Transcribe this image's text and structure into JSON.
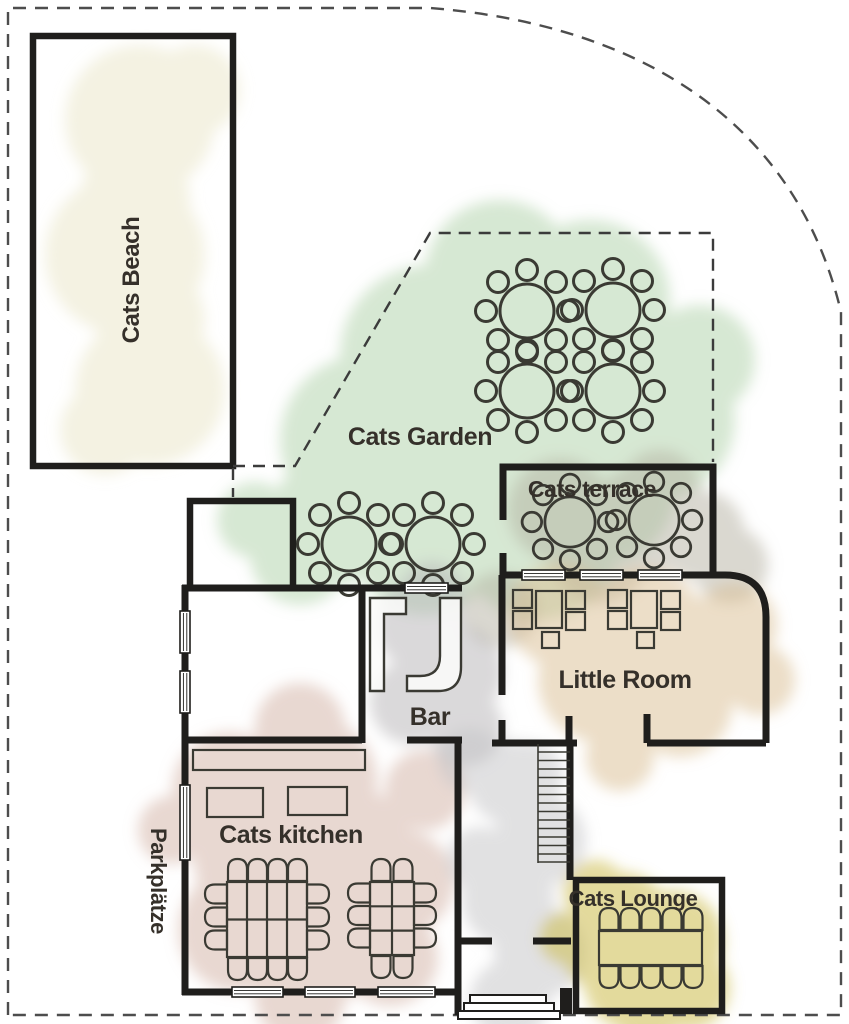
{
  "labels": {
    "beach": "Cats Beach",
    "garden": "Cats Garden",
    "terrace": "Cats terrace",
    "little_room": "Little Room",
    "bar": "Bar",
    "kitchen": "Cats kitchen",
    "lounge": "Cats Lounge",
    "parking": "Parkplätze"
  },
  "colors": {
    "wall": "#1f1e1c",
    "furniture": "#3a3a33",
    "text": "#35302a",
    "boundary_dash": "#4d4d4d",
    "garden_dash": "#3b3b3b",
    "beach": "#e9e6c6",
    "garden": "#a5cc9e",
    "terrace": "#b5b2a1",
    "little_room": "#d9bd92",
    "kitchen": "#d2b2a3",
    "bar": "#b9b6b8",
    "corridor": "#c4c3c6",
    "lounge": "#cdbc4e",
    "window_fill": "#ffffff"
  },
  "furniture_summary": {
    "garden": {
      "round_tables": 6,
      "seats_per_table": 8
    },
    "terrace": {
      "round_tables": 2,
      "seats_per_table": 8
    },
    "little_room": {
      "seating_groups": 2,
      "seats_per_group": 5
    },
    "kitchen": {
      "large_tables": 2,
      "seats": 24
    },
    "lounge": {
      "tables": 1,
      "seats": 10
    }
  }
}
